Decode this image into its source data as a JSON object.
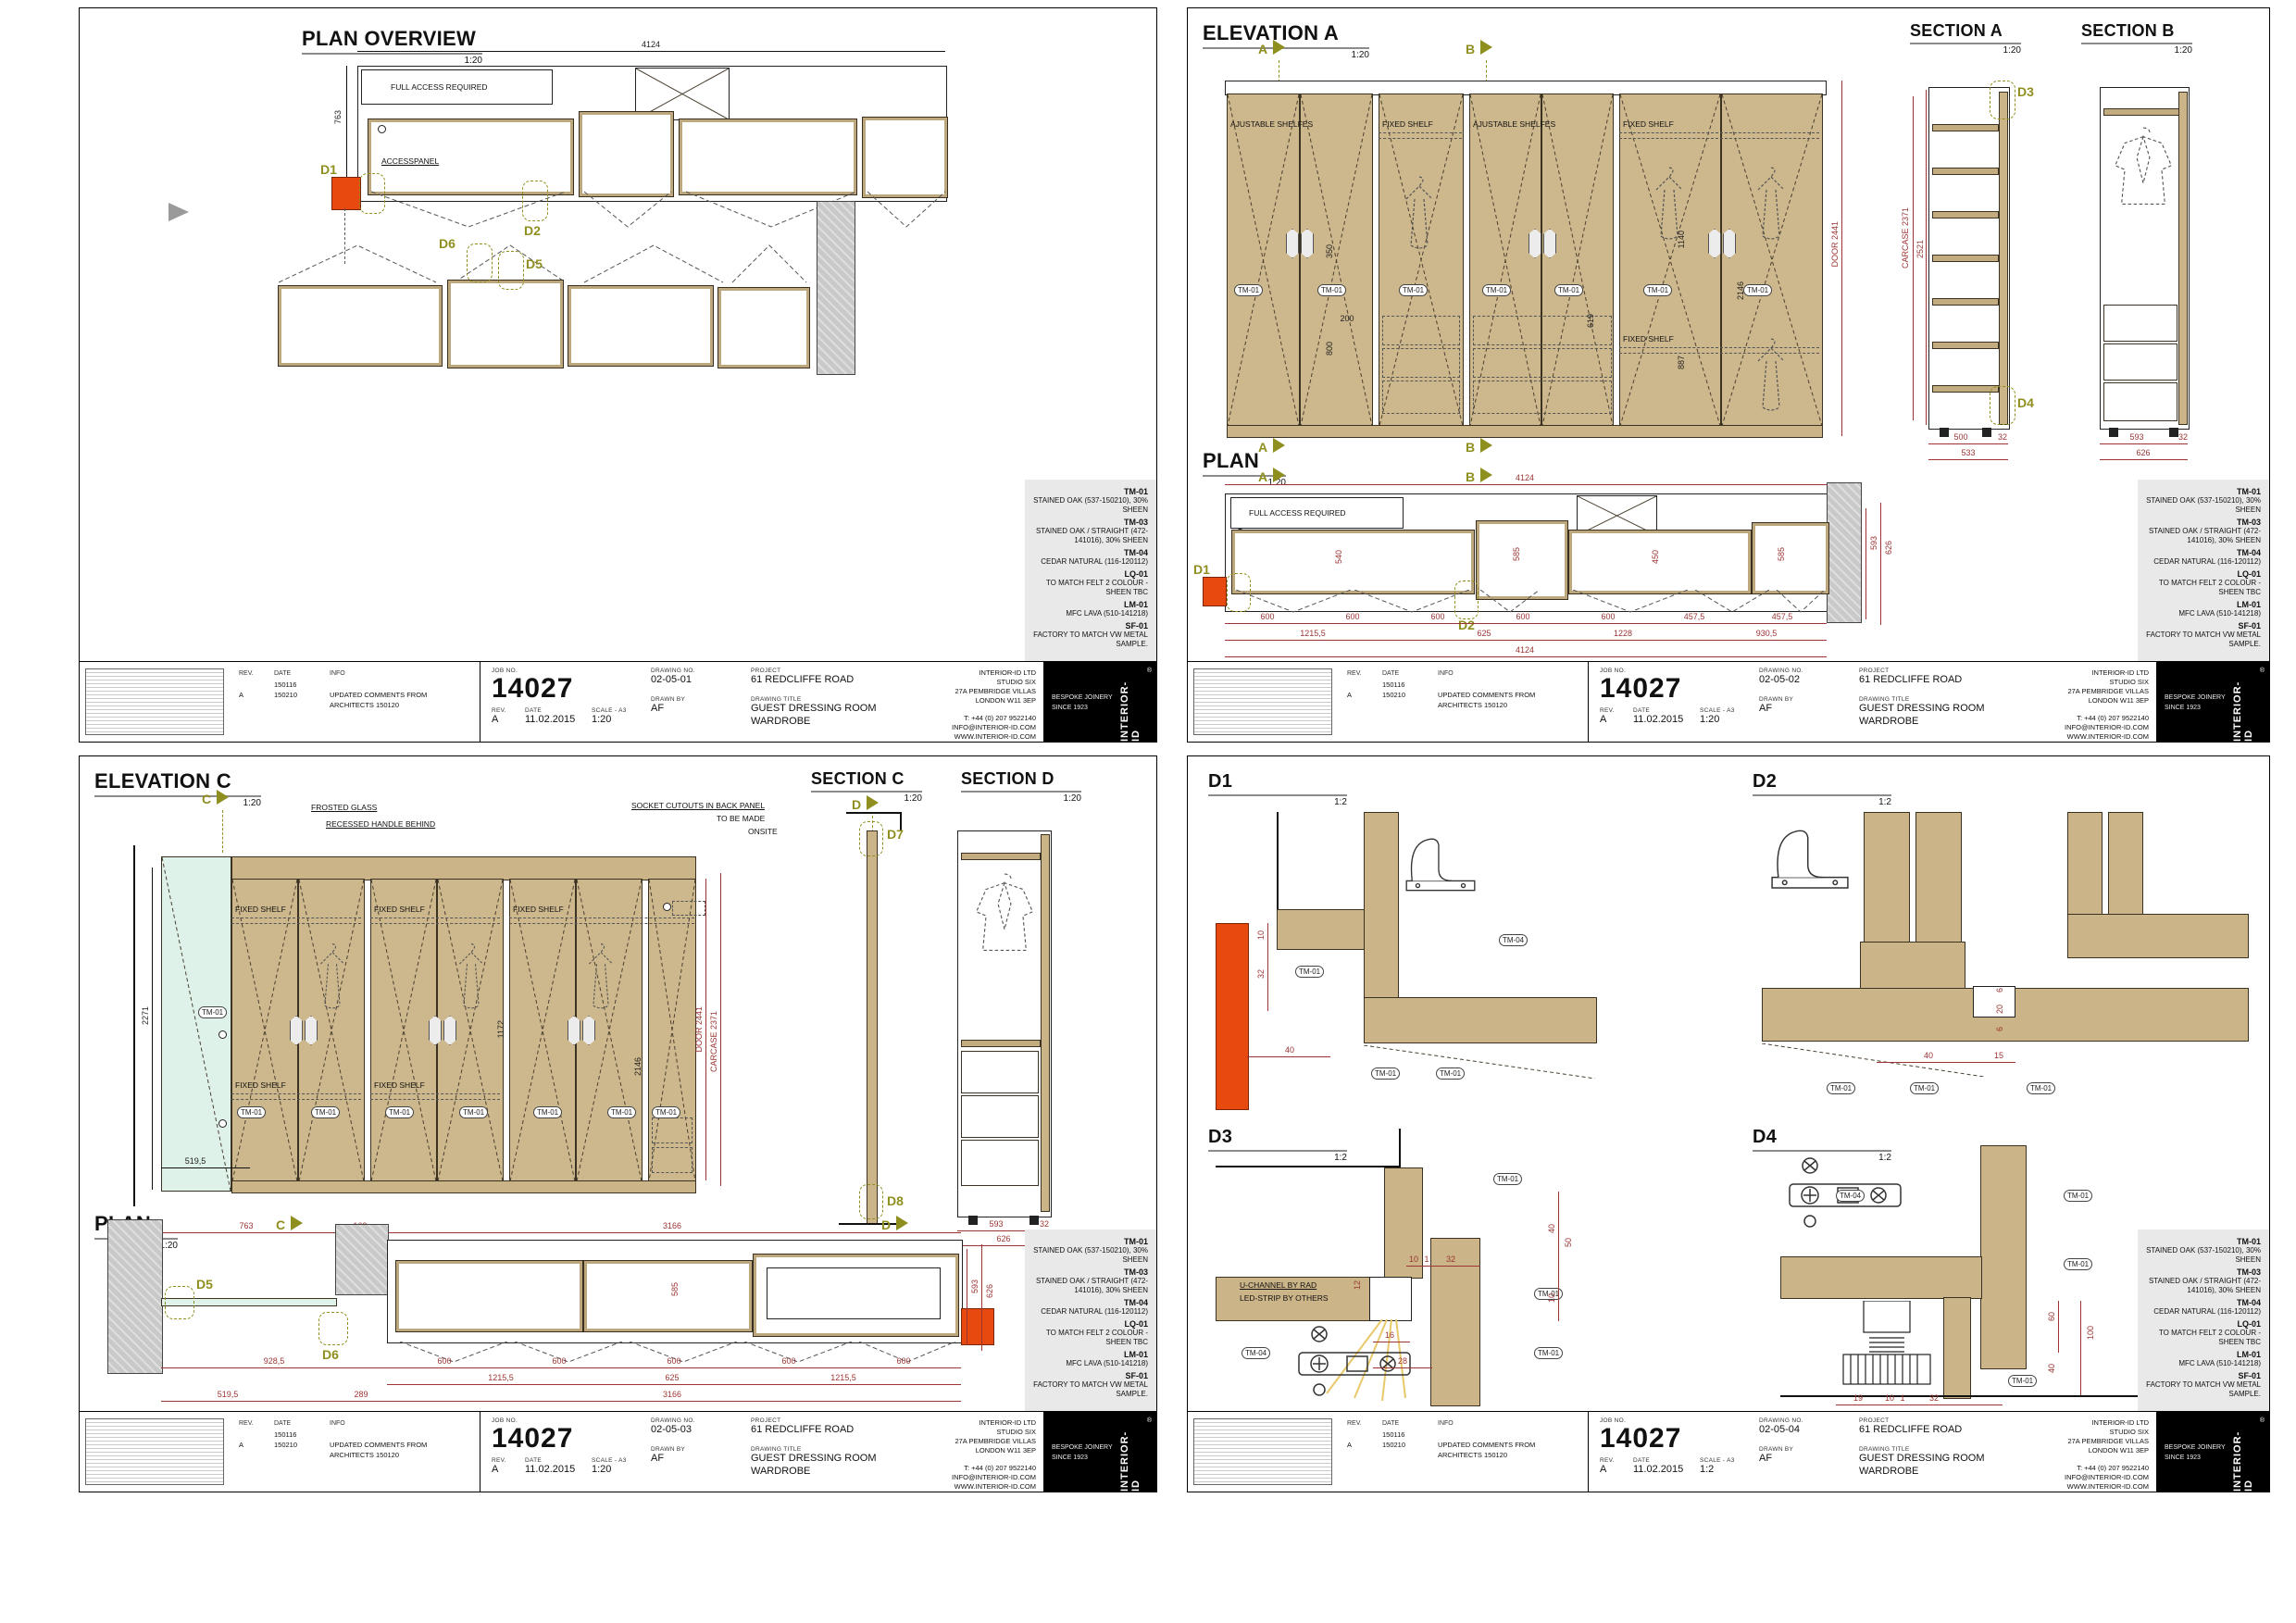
{
  "tags": {
    "tm01": "TM-01",
    "tm04": "TM-04"
  },
  "common": {
    "plan_title": "PLAN",
    "scale_120": "1:20",
    "scale_12": "1:2",
    "full_access": "FULL ACCESS REQUIRED",
    "access_panel": "ACCESSPANEL",
    "fixed_shelf": "FIXED SHELF",
    "adjustable_shelves": "AJUSTABLE SHELFES"
  },
  "titleblock": {
    "labels": {
      "job_no": "JOB NO.",
      "drawing_no": "DRAWING NO.",
      "project": "PROJECT",
      "drawn_by": "DRAWN BY",
      "drawing_title": "DRAWING TITLE",
      "rev": "REV.",
      "date": "DATE",
      "scale": "SCALE - A3",
      "info": "INFO"
    },
    "job_no": "14027",
    "project": "61 REDCLIFFE ROAD",
    "drawn_by": "AF",
    "title_line1": "GUEST DRESSING ROOM",
    "title_line2": "WARDROBE",
    "rev": "A",
    "date": "11.02.2015",
    "company": [
      "INTERIOR-ID LTD",
      "STUDIO SIX",
      "27A PEMBRIDGE VILLAS",
      "LONDON W11 3EP"
    ],
    "contact": [
      "T: +44 (0) 207 9522140",
      "INFO@INTERIOR-ID.COM",
      "WWW.INTERIOR-ID.COM"
    ],
    "logo_line1": "BESPOKE JOINERY",
    "logo_line2": "SINCE 1923",
    "logo_mark": "INTERIOR-ID",
    "logo_reg": "®"
  },
  "revisions": [
    {
      "rev": "",
      "date": "150116",
      "info": ""
    },
    {
      "rev": "A",
      "date": "150210",
      "info": "UPDATED COMMENTS FROM ARCHITECTS 150120"
    }
  ],
  "materials": [
    {
      "code": "TM-01",
      "desc": "STAINED OAK (537-150210), 30% SHEEN"
    },
    {
      "code": "TM-03",
      "desc": "STAINED OAK / STRAIGHT (472-141016), 30% SHEEN"
    },
    {
      "code": "TM-04",
      "desc": "CEDAR NATURAL (116-120112)"
    },
    {
      "code": "LQ-01",
      "desc": "TO MATCH FELT 2 COLOUR - SHEEN TBC"
    },
    {
      "code": "LM-01",
      "desc": "MFC LAVA (510-141218)"
    },
    {
      "code": "SF-01",
      "desc": "FACTORY TO MATCH VW METAL SAMPLE."
    }
  ],
  "sheets": {
    "s1": {
      "drawing_no": "02-05-01",
      "scale": "1:20",
      "title": "PLAN OVERVIEW",
      "markers": {
        "d1": "D1",
        "d2": "D2",
        "d5": "D5",
        "d6": "D6"
      },
      "dims": {
        "top": "4124",
        "left": "763"
      }
    },
    "s2": {
      "drawing_no": "02-05-02",
      "scale": "1:20",
      "elev": {
        "title": "ELEVATION A",
        "flag_a": "A",
        "flag_b": "B",
        "door_dim": "DOOR 2441",
        "dims": {
          "d800": "800",
          "d350": "350",
          "d200": "200",
          "d619": "619",
          "d887": "887",
          "d1140": "1140",
          "d2146": "2146"
        }
      },
      "seca": {
        "title": "SECTION A",
        "d3": "D3",
        "d4": "D4",
        "carcase": "CARCASE 2371",
        "total": "2521",
        "b1": "500",
        "b2": "32",
        "b3": "533"
      },
      "secb": {
        "title": "SECTION B",
        "b1": "593",
        "b2": "32",
        "b3": "626"
      },
      "plan": {
        "d1": "D1",
        "d2": "D2",
        "top": "4124",
        "r1": [
          "600",
          "600",
          "600",
          "600",
          "600",
          "457,5",
          "457,5"
        ],
        "r2": [
          "1215,5",
          "625",
          "1228",
          "930,5"
        ],
        "total": "4124",
        "right": [
          "593",
          "626"
        ],
        "inner": [
          "540",
          "585",
          "450",
          "585"
        ]
      }
    },
    "s3": {
      "drawing_no": "02-05-03",
      "scale": "1:20",
      "elev": {
        "title": "ELEVATION C",
        "flag_c": "C",
        "flag_d": "D",
        "note_glass": "FROSTED GLASS",
        "note_handle": "RECESSED HANDLE BEHIND",
        "socket1": "SOCKET CUTOUTS IN BACK PANEL",
        "socket2": "TO BE MADE",
        "socket3": "ONSITE",
        "glass_h": "2271",
        "glass_w": "519,5",
        "inner1": "1172",
        "inner2": "2146",
        "door_dim": "DOOR 2441",
        "carcase_dim": "CARCASE 2371"
      },
      "secc": {
        "title": "SECTION C",
        "d7": "D7",
        "d8": "D8"
      },
      "secd": {
        "title": "SECTION D",
        "b1": "593",
        "b2": "32",
        "b3": "626"
      },
      "plan": {
        "d5": "D5",
        "d6": "D6",
        "flag_c": "C",
        "flag_d": "D",
        "t1": "763",
        "t2": "169",
        "t3": "3166",
        "r1": [
          "928,5",
          "600",
          "600",
          "600",
          "600",
          "600"
        ],
        "r2": [
          "1215,5",
          "625",
          "1215,5"
        ],
        "total": "3166",
        "l1": "519,5",
        "l2": "289",
        "right": [
          "593",
          "626"
        ],
        "inner": "585"
      }
    },
    "s4": {
      "drawing_no": "02-05-04",
      "scale": "1:2",
      "d1": {
        "title": "D1",
        "v1": "10",
        "v2": "32",
        "h1": "40"
      },
      "d2": {
        "title": "D2",
        "v1": "6",
        "v2": "20",
        "v3": "6",
        "h1": "40",
        "h2": "15"
      },
      "d3": {
        "title": "D3",
        "note1": "U-CHANNEL BY RAD",
        "note2": "LED-STRIP BY OTHERS",
        "h1": "10",
        "h2": "1",
        "h3": "32",
        "v1": "40",
        "v2": "50",
        "v3": "10",
        "v4": "12",
        "h4": "16",
        "h5": "28"
      },
      "d4": {
        "title": "D4",
        "v1": "60",
        "v2": "100",
        "v3": "40",
        "b1": "19",
        "b2": "10",
        "b3": "1",
        "b4": "32"
      }
    }
  }
}
